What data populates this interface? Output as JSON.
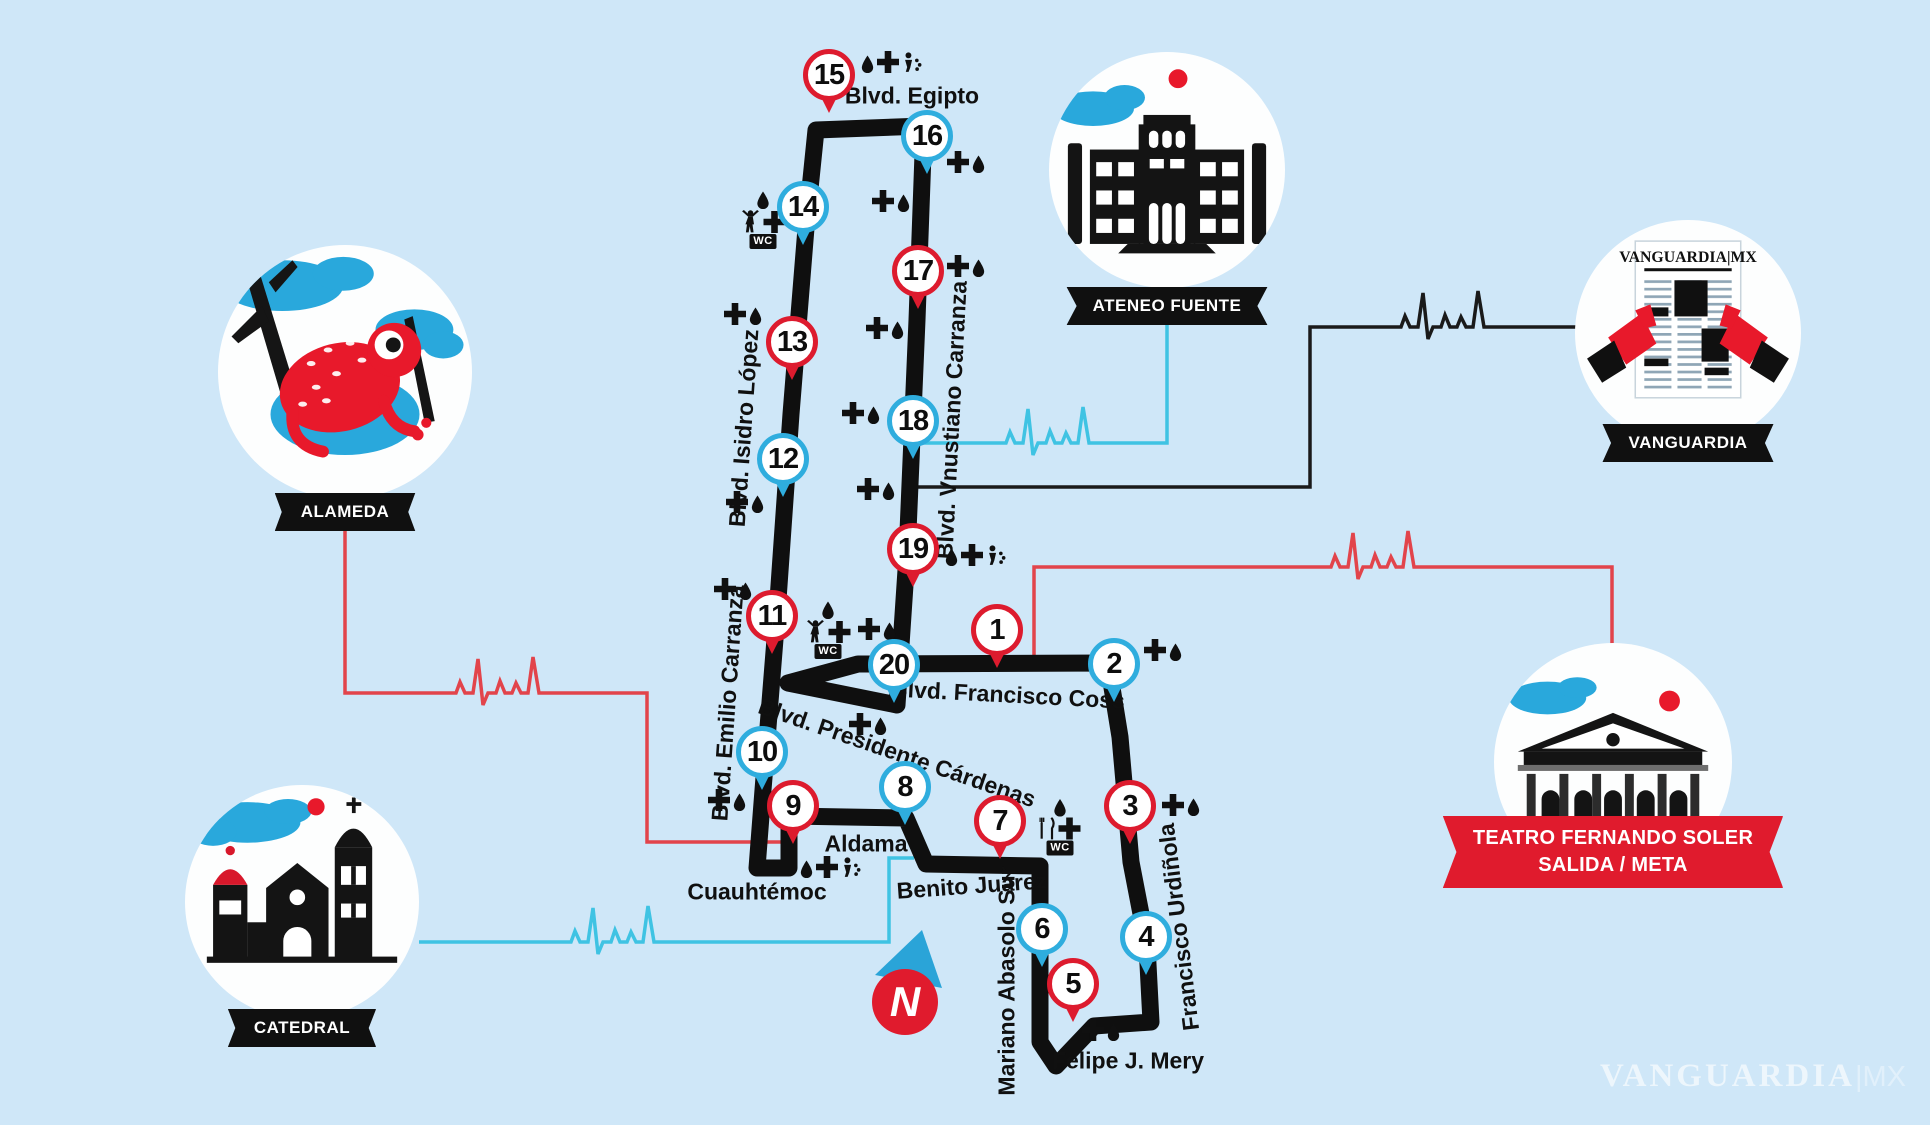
{
  "colors": {
    "bg": "#cfe7f8",
    "road": "#0f0f0f",
    "pin_red": "#dd1b2e",
    "pin_blue": "#2fadde",
    "line_cyan": "#3fc3e3",
    "line_red": "#e2444b",
    "line_black": "#1a1a1a",
    "banner": "#101010",
    "ribbon_red": "#e01b2d",
    "blue_art": "#29a8dc",
    "red_art": "#e8192b"
  },
  "compass": {
    "label": "N"
  },
  "watermark": {
    "brand": "VANGUARDIA",
    "suffix": "|MX"
  },
  "icon_labels": {
    "wc": "WC"
  },
  "markers": [
    {
      "number": 1,
      "color": "red",
      "x": 997,
      "y": 630
    },
    {
      "number": 2,
      "color": "blue",
      "x": 1114,
      "y": 664
    },
    {
      "number": 3,
      "color": "red",
      "x": 1130,
      "y": 806
    },
    {
      "number": 4,
      "color": "blue",
      "x": 1146,
      "y": 937
    },
    {
      "number": 5,
      "color": "red",
      "x": 1073,
      "y": 984
    },
    {
      "number": 6,
      "color": "blue",
      "x": 1042,
      "y": 929
    },
    {
      "number": 7,
      "color": "red",
      "x": 1000,
      "y": 821
    },
    {
      "number": 8,
      "color": "blue",
      "x": 905,
      "y": 787
    },
    {
      "number": 9,
      "color": "red",
      "x": 793,
      "y": 806
    },
    {
      "number": 10,
      "color": "blue",
      "x": 762,
      "y": 752
    },
    {
      "number": 11,
      "color": "red",
      "x": 772,
      "y": 616
    },
    {
      "number": 12,
      "color": "blue",
      "x": 783,
      "y": 459
    },
    {
      "number": 13,
      "color": "red",
      "x": 792,
      "y": 342
    },
    {
      "number": 14,
      "color": "blue",
      "x": 803,
      "y": 207
    },
    {
      "number": 15,
      "color": "red",
      "x": 829,
      "y": 75
    },
    {
      "number": 16,
      "color": "blue",
      "x": 927,
      "y": 136
    },
    {
      "number": 17,
      "color": "red",
      "x": 918,
      "y": 271
    },
    {
      "number": 18,
      "color": "blue",
      "x": 913,
      "y": 421
    },
    {
      "number": 19,
      "color": "red",
      "x": 913,
      "y": 549
    },
    {
      "number": 20,
      "color": "blue",
      "x": 894,
      "y": 665
    }
  ],
  "streets": [
    {
      "name": "Blvd. Egipto",
      "x": 912,
      "y": 96,
      "rotate": 0
    },
    {
      "name": "Blvd. Isidro López",
      "x": 744,
      "y": 428,
      "rotate": -86
    },
    {
      "name": "Blvd. Vnustiano Carranza",
      "x": 952,
      "y": 420,
      "rotate": -87
    },
    {
      "name": "Blvd. Emilio Carranza",
      "x": 728,
      "y": 703,
      "rotate": -86
    },
    {
      "name": "Blvd. Francisco Coss",
      "x": 1008,
      "y": 695,
      "rotate": 3
    },
    {
      "name": "Blvd. Presidente Cárdenas",
      "x": 897,
      "y": 753,
      "rotate": 19
    },
    {
      "name": "Aldama",
      "x": 866,
      "y": 844,
      "rotate": 0
    },
    {
      "name": "Benito Juárez",
      "x": 972,
      "y": 886,
      "rotate": -4
    },
    {
      "name": "Cuauhtémoc",
      "x": 757,
      "y": 892,
      "rotate": 0
    },
    {
      "name": "Felipe J. Mery",
      "x": 1128,
      "y": 1061,
      "rotate": 0
    },
    {
      "name": "Mariano Abasolo Sur",
      "x": 1007,
      "y": 981,
      "rotate": -90
    },
    {
      "name": "Francisco Urdiñola",
      "x": 1179,
      "y": 927,
      "rotate": -97
    }
  ],
  "amenities": [
    {
      "x": 892,
      "y": 62,
      "rows": [
        [
          "water",
          "medical",
          "shower"
        ]
      ]
    },
    {
      "x": 966,
      "y": 162,
      "rows": [
        [
          "medical",
          "water"
        ]
      ]
    },
    {
      "x": 891,
      "y": 201,
      "rows": [
        [
          "medical",
          "water"
        ]
      ]
    },
    {
      "x": 966,
      "y": 266,
      "rows": [
        [
          "medical",
          "water"
        ]
      ]
    },
    {
      "x": 885,
      "y": 328,
      "rows": [
        [
          "medical",
          "water"
        ]
      ]
    },
    {
      "x": 861,
      "y": 413,
      "rows": [
        [
          "medical",
          "water"
        ]
      ]
    },
    {
      "x": 876,
      "y": 489,
      "rows": [
        [
          "medical",
          "water"
        ]
      ]
    },
    {
      "x": 976,
      "y": 555,
      "rows": [
        [
          "water",
          "medical",
          "shower"
        ]
      ]
    },
    {
      "x": 763,
      "y": 220,
      "rows": [
        [
          "water"
        ],
        [
          "runner",
          "medical"
        ],
        [
          "wc"
        ]
      ]
    },
    {
      "x": 743,
      "y": 314,
      "rows": [
        [
          "medical",
          "water"
        ]
      ]
    },
    {
      "x": 745,
      "y": 502,
      "rows": [
        [
          "medical",
          "water"
        ]
      ]
    },
    {
      "x": 733,
      "y": 589,
      "rows": [
        [
          "medical",
          "water"
        ]
      ]
    },
    {
      "x": 828,
      "y": 630,
      "rows": [
        [
          "water"
        ],
        [
          "runner",
          "medical"
        ],
        [
          "wc"
        ]
      ]
    },
    {
      "x": 877,
      "y": 629,
      "rows": [
        [
          "medical",
          "water"
        ]
      ]
    },
    {
      "x": 868,
      "y": 724,
      "rows": [
        [
          "medical",
          "water"
        ]
      ]
    },
    {
      "x": 727,
      "y": 800,
      "rows": [
        [
          "medical",
          "water"
        ]
      ]
    },
    {
      "x": 831,
      "y": 867,
      "rows": [
        [
          "water",
          "medical",
          "shower"
        ]
      ]
    },
    {
      "x": 1060,
      "y": 827,
      "rows": [
        [
          "water"
        ],
        [
          "food",
          "medical"
        ],
        [
          "wc"
        ]
      ]
    },
    {
      "x": 1163,
      "y": 650,
      "rows": [
        [
          "medical",
          "water"
        ]
      ]
    },
    {
      "x": 1181,
      "y": 805,
      "rows": [
        [
          "medical",
          "water"
        ]
      ]
    },
    {
      "x": 1101,
      "y": 1030,
      "rows": [
        [
          "medical",
          "water"
        ]
      ]
    }
  ],
  "landmarks": {
    "alameda": {
      "label": "ALAMEDA"
    },
    "catedral": {
      "label": "CATEDRAL"
    },
    "ateneo": {
      "label": "ATENEO FUENTE"
    },
    "vanguardia": {
      "label": "VANGUARDIA",
      "masthead": "VANGUARDIA|MX"
    },
    "teatro": {
      "label_line1": "TEATRO FERNANDO SOLER",
      "label_line2": "SALIDA / META"
    }
  }
}
